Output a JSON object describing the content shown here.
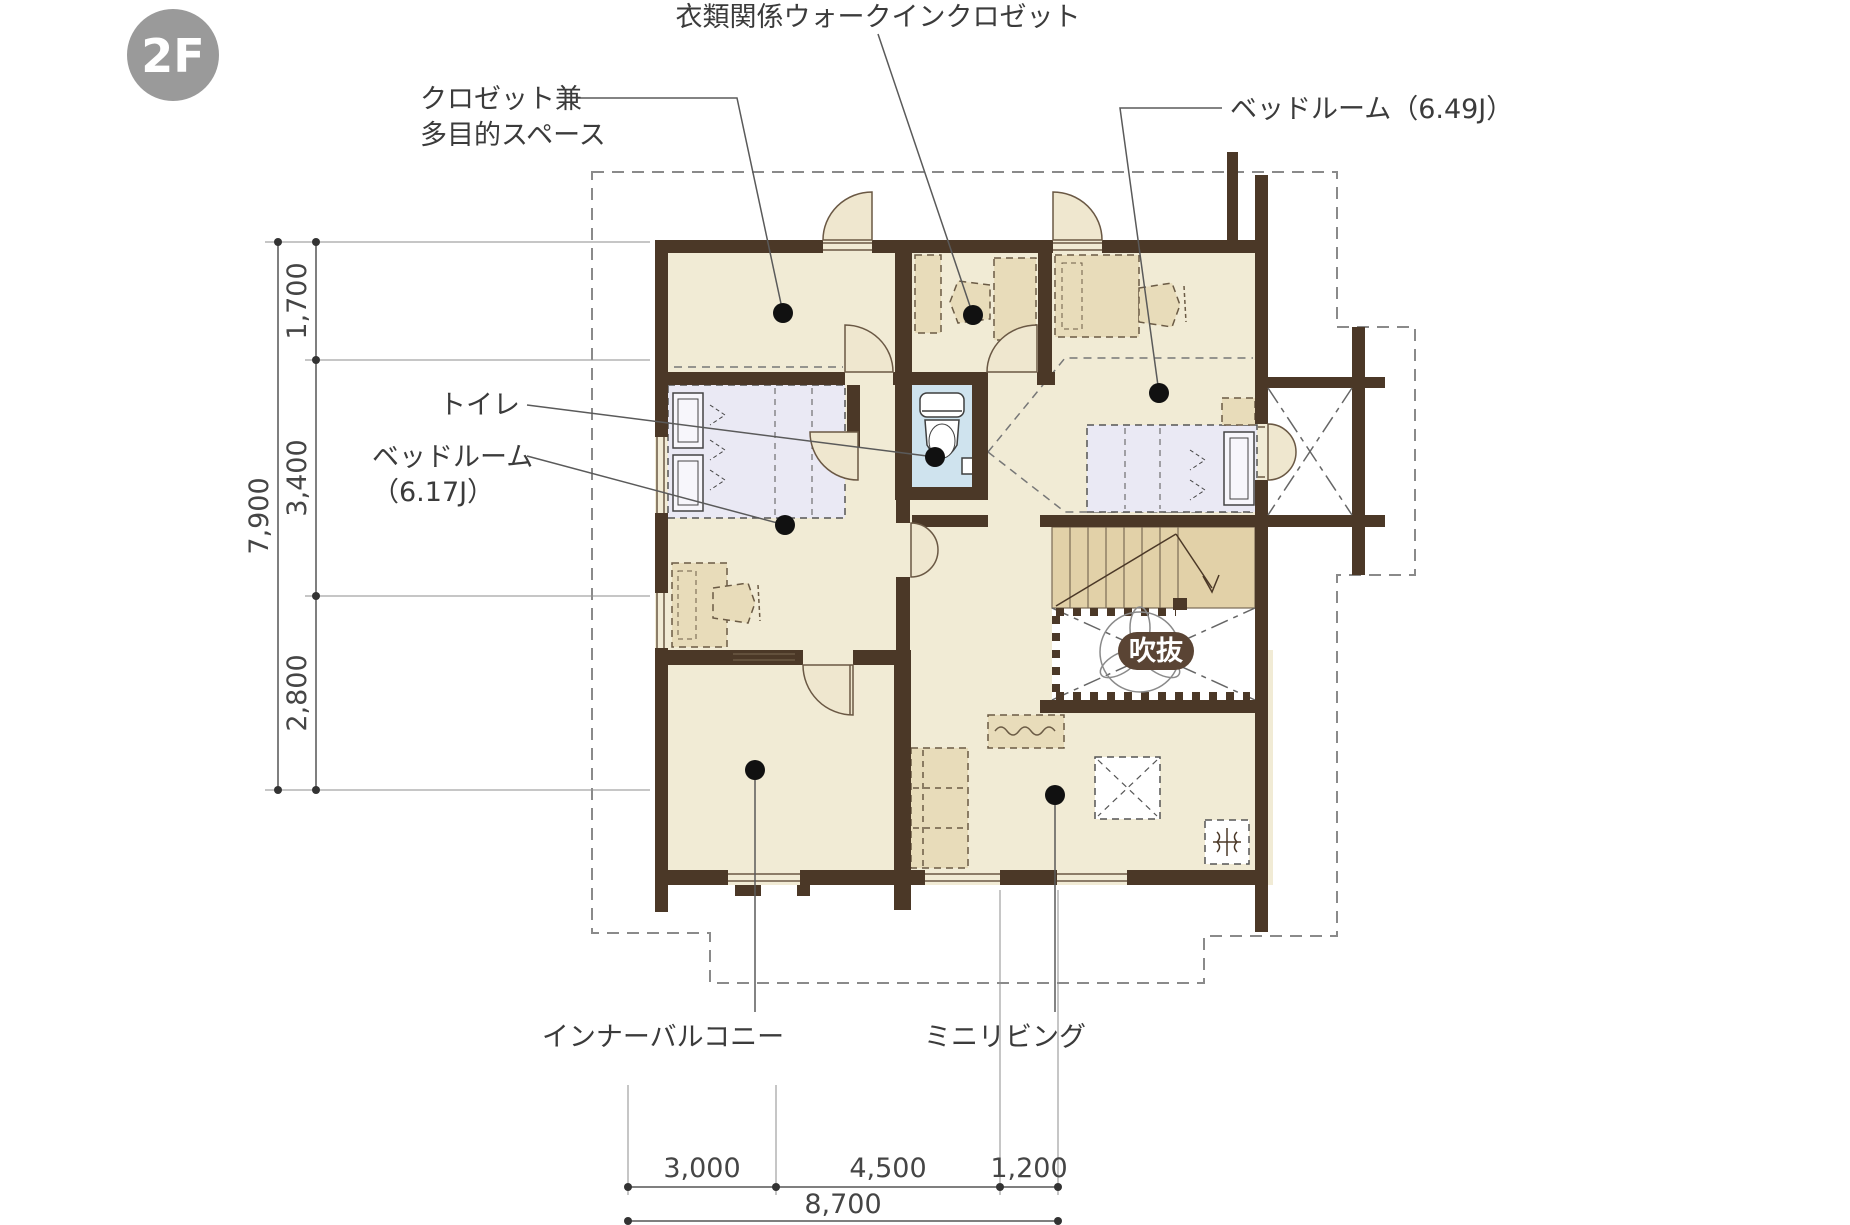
{
  "floor_badge": "2F",
  "labels": {
    "wic": "衣類関係ウォークインクロゼット",
    "closet_1": "クロゼット兼",
    "closet_2": "多目的スペース",
    "bedroom_649": "ベッドルーム（6.49J）",
    "toilet": "トイレ",
    "bedroom_617_1": "ベッドルーム",
    "bedroom_617_2": "（6.17J）",
    "inner_balcony": "インナーバルコニー",
    "mini_living": "ミニリビング",
    "void": "吹抜"
  },
  "dimensions": {
    "left": {
      "segments": [
        "1,700",
        "3,400",
        "2,800"
      ],
      "total": "7,900"
    },
    "bottom": {
      "segments": [
        "3,000",
        "4,500",
        "1,200"
      ],
      "total": "8,700"
    }
  },
  "colors": {
    "wall": "#4b3827",
    "floor": "#f1ebd5",
    "toilet_floor": "#cfe3ee",
    "stairs": "#e2d1a8",
    "furniture": "#e8dcba",
    "bed": "#eae9f4",
    "badge": "#9a9a9a",
    "void_pill": "#5a4434",
    "text": "#3b3b3b"
  }
}
